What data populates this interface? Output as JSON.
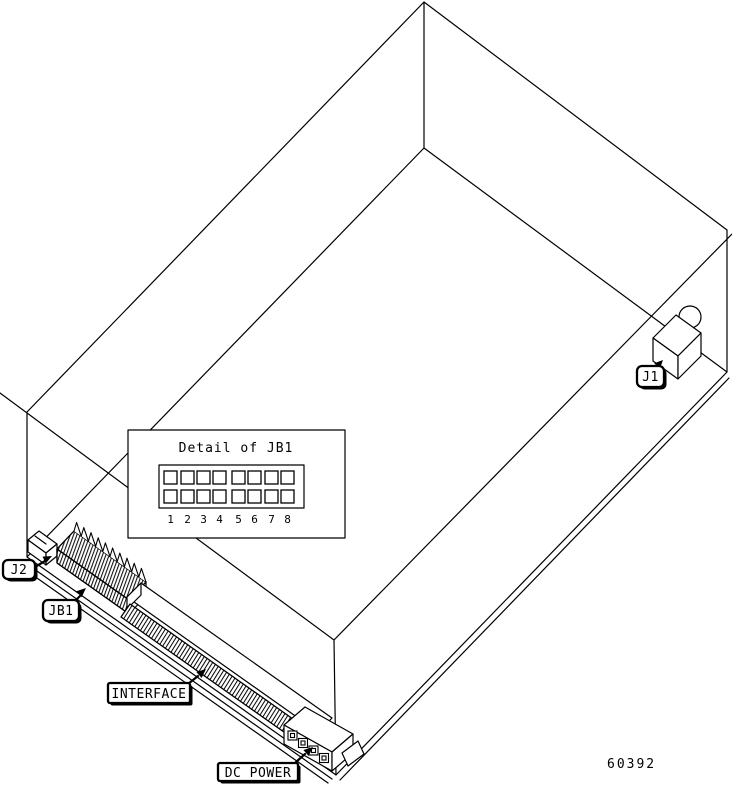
{
  "diagram": {
    "figure_number": "60392",
    "inset": {
      "title": "Detail of JB1",
      "pins": [
        "1",
        "2",
        "3",
        "4",
        "5",
        "6",
        "7",
        "8"
      ]
    },
    "labels": {
      "j1": "J1",
      "j2": "J2",
      "jb1": "JB1",
      "interface": "INTERFACE",
      "dc_power": "DC POWER"
    },
    "colors": {
      "line": "#000000",
      "background": "#ffffff"
    }
  }
}
